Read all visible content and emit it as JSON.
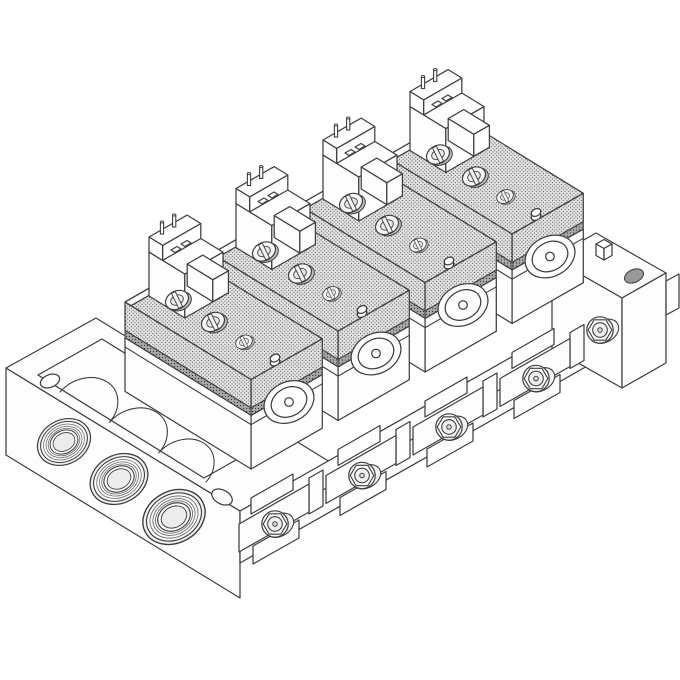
{
  "image": {
    "type": "isometric technical line illustration",
    "title": "Four-station solenoid valve manifold assembly",
    "description": "Black-and-white isometric line drawing of a pneumatic manifold assembly. Four pilot solenoid valves, each with two electrical terminal pins, are mounted on halftone-stippled interface plates fastened with slotted screws to a common manifold base. The base has a left end flange with three large threaded common ports and a mounting hole, a recessed tray showing cast flow passages, four front clamp brackets with hex bolts, and a right end block with a hex fitting, top hole and locating peg.",
    "background_color": "#ffffff",
    "line_color": "#3f3f3f",
    "halftone_fill": "#e4e4e4",
    "gasket_band_fill": "#a8a8a8"
  },
  "components": {
    "valve_station": {
      "label": "pilot solenoid valve station",
      "count": 4
    },
    "terminal_pins_per_station": 2,
    "interface_plate": {
      "label": "stippled interface plate with slotted screws",
      "count": 4
    },
    "slotted_screws_per_plate": 3,
    "threaded_port": {
      "label": "threaded common port on end flange",
      "count": 3
    },
    "clamp_bracket": {
      "label": "front clamp bracket with hex bolt",
      "count": 4
    },
    "end_block": {
      "label": "right end block with hex fitting",
      "count": 1
    },
    "mounting_hole": {
      "label": "flange mounting hole",
      "count": 2
    },
    "passage_tray": {
      "label": "recessed tray with cast flow passages",
      "count": 1
    }
  }
}
